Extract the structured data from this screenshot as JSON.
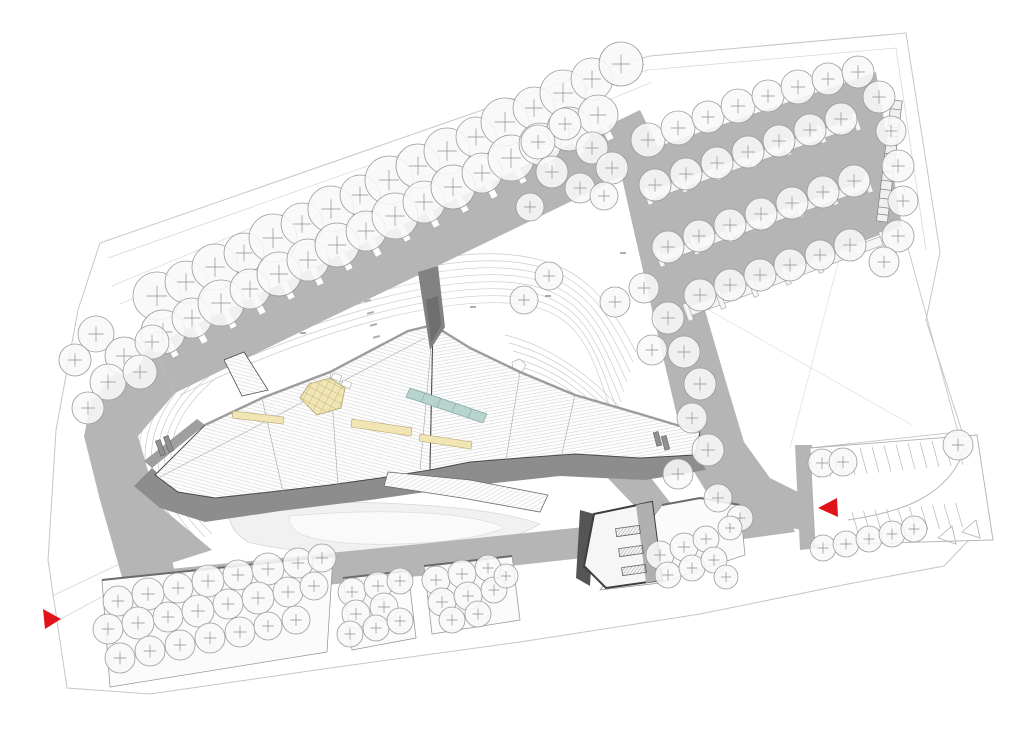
{
  "plan": {
    "kind": "architectural-site-plan",
    "canvas": {
      "width": 1024,
      "height": 737
    },
    "colors": {
      "background": "#ffffff",
      "paper_line": "#c6c6c6",
      "faint_line": "#dedede",
      "contour_line": "#cccccc",
      "road": "#b5b5b5",
      "road_edge": "#a3a3a3",
      "shadow": "#8d8d8d",
      "shadow_dark": "#6e6e6e",
      "building_outline": "#4a4a4a",
      "roof_hatch": "#c6c6c6",
      "roof_fill": "#fdfdfd",
      "tree_fill": "#f8f8f8",
      "tree_stroke": "#9b9b9b",
      "tree_cross": "#8f8f8f",
      "trunk_fill": "#ffffff",
      "trunk_stroke": "#ababab",
      "island_fill": "#f5f5f5",
      "island_stroke": "#a8a8a8",
      "stall_line": "#b8b8b8",
      "skylight_fill": "#f1e5b4",
      "skylight_line": "#b4a46e",
      "glass_fill": "#b9d3cf",
      "glass_line": "#7fa8a3",
      "plaza_fill": "#f1f1f1",
      "plaza_line": "#d8d8d8",
      "bed_fill": "#fbfbfb",
      "bed_edge": "#6a6a6a",
      "arrow_red": "#e0131b"
    },
    "markers": {
      "entrance_west": {
        "shape": "triangle",
        "direction": "right"
      },
      "entrance_east": {
        "shape": "triangle",
        "direction": "left"
      }
    },
    "trees": {
      "boulevard_upper": [
        [
          157,
          296,
          24
        ],
        [
          186,
          282,
          21
        ],
        [
          215,
          267,
          23
        ],
        [
          244,
          253,
          20
        ],
        [
          273,
          238,
          24
        ],
        [
          302,
          224,
          21
        ],
        [
          331,
          209,
          23
        ],
        [
          360,
          195,
          20
        ],
        [
          389,
          180,
          24
        ],
        [
          418,
          166,
          22
        ],
        [
          447,
          151,
          23
        ],
        [
          476,
          137,
          20
        ],
        [
          505,
          122,
          24
        ],
        [
          534,
          108,
          21
        ],
        [
          563,
          93,
          23
        ],
        [
          592,
          79,
          21
        ],
        [
          621,
          64,
          22
        ]
      ],
      "boulevard_lower": [
        [
          163,
          332,
          22
        ],
        [
          192,
          318,
          20
        ],
        [
          221,
          303,
          23
        ],
        [
          250,
          289,
          20
        ],
        [
          279,
          274,
          22
        ],
        [
          308,
          260,
          21
        ],
        [
          337,
          245,
          22
        ],
        [
          366,
          231,
          20
        ],
        [
          395,
          216,
          23
        ],
        [
          424,
          202,
          21
        ],
        [
          453,
          187,
          22
        ],
        [
          482,
          173,
          20
        ],
        [
          511,
          158,
          23
        ],
        [
          540,
          144,
          21
        ],
        [
          569,
          129,
          22
        ],
        [
          598,
          115,
          20
        ]
      ],
      "elbow_cluster": [
        [
          96,
          334,
          18
        ],
        [
          124,
          356,
          19
        ],
        [
          152,
          342,
          17
        ],
        [
          108,
          382,
          18
        ],
        [
          140,
          372,
          17
        ],
        [
          75,
          360,
          16
        ],
        [
          88,
          408,
          16
        ]
      ],
      "northeast_wedge": [
        [
          538,
          142,
          17
        ],
        [
          565,
          124,
          16
        ],
        [
          592,
          148,
          16
        ],
        [
          552,
          172,
          16
        ],
        [
          612,
          168,
          16
        ],
        [
          580,
          188,
          15
        ],
        [
          604,
          196,
          14
        ],
        [
          530,
          207,
          14
        ]
      ],
      "parking_top_edge": [
        [
          648,
          140,
          17
        ],
        [
          678,
          128,
          17
        ],
        [
          708,
          117,
          16
        ],
        [
          738,
          106,
          17
        ],
        [
          768,
          96,
          16
        ],
        [
          798,
          87,
          17
        ],
        [
          828,
          79,
          16
        ],
        [
          858,
          72,
          16
        ]
      ],
      "parking_right_edge": [
        [
          879,
          97,
          16
        ],
        [
          891,
          131,
          15
        ],
        [
          898,
          166,
          16
        ],
        [
          903,
          201,
          15
        ],
        [
          898,
          236,
          16
        ],
        [
          884,
          262,
          15
        ]
      ],
      "parking_row_a": [
        [
          655,
          185,
          16
        ],
        [
          686,
          174,
          16
        ],
        [
          717,
          163,
          16
        ],
        [
          748,
          152,
          16
        ],
        [
          779,
          141,
          16
        ],
        [
          810,
          130,
          16
        ],
        [
          841,
          119,
          16
        ]
      ],
      "parking_row_b": [
        [
          668,
          247,
          16
        ],
        [
          699,
          236,
          16
        ],
        [
          730,
          225,
          16
        ],
        [
          761,
          214,
          16
        ],
        [
          792,
          203,
          16
        ],
        [
          823,
          192,
          16
        ],
        [
          854,
          181,
          16
        ]
      ],
      "parking_south_edge": [
        [
          700,
          295,
          16
        ],
        [
          730,
          285,
          16
        ],
        [
          760,
          275,
          16
        ],
        [
          790,
          265,
          16
        ],
        [
          820,
          255,
          15
        ],
        [
          850,
          245,
          16
        ]
      ],
      "east_road_side": [
        [
          615,
          302,
          15
        ],
        [
          644,
          288,
          15
        ],
        [
          668,
          318,
          16
        ],
        [
          652,
          350,
          15
        ],
        [
          684,
          352,
          16
        ],
        [
          700,
          384,
          16
        ],
        [
          692,
          418,
          15
        ],
        [
          708,
          450,
          16
        ],
        [
          678,
          474,
          15
        ],
        [
          524,
          300,
          14
        ],
        [
          549,
          276,
          14
        ],
        [
          718,
          498,
          14
        ],
        [
          740,
          518,
          13
        ]
      ],
      "right_strip": [
        [
          822,
          463,
          14
        ],
        [
          843,
          462,
          14
        ],
        [
          958,
          445,
          15
        ],
        [
          823,
          548,
          13
        ],
        [
          846,
          544,
          13
        ],
        [
          869,
          539,
          13
        ],
        [
          892,
          534,
          13
        ],
        [
          914,
          529,
          13
        ]
      ],
      "bed1": [
        [
          118,
          601,
          15
        ],
        [
          148,
          594,
          16
        ],
        [
          178,
          588,
          15
        ],
        [
          208,
          581,
          16
        ],
        [
          238,
          575,
          15
        ],
        [
          268,
          569,
          16
        ],
        [
          298,
          563,
          15
        ],
        [
          322,
          558,
          14
        ],
        [
          108,
          629,
          15
        ],
        [
          138,
          623,
          16
        ],
        [
          168,
          617,
          15
        ],
        [
          198,
          611,
          16
        ],
        [
          228,
          604,
          15
        ],
        [
          258,
          598,
          16
        ],
        [
          288,
          592,
          15
        ],
        [
          314,
          586,
          14
        ],
        [
          120,
          658,
          15
        ],
        [
          150,
          651,
          15
        ],
        [
          180,
          645,
          15
        ],
        [
          210,
          638,
          15
        ],
        [
          240,
          632,
          15
        ],
        [
          268,
          626,
          14
        ],
        [
          296,
          620,
          14
        ]
      ],
      "bed2": [
        [
          352,
          592,
          14
        ],
        [
          378,
          586,
          14
        ],
        [
          400,
          581,
          13
        ],
        [
          356,
          614,
          14
        ],
        [
          384,
          607,
          14
        ],
        [
          350,
          634,
          13
        ],
        [
          376,
          628,
          13
        ],
        [
          400,
          621,
          13
        ]
      ],
      "bed3": [
        [
          436,
          580,
          14
        ],
        [
          462,
          574,
          14
        ],
        [
          488,
          568,
          13
        ],
        [
          442,
          602,
          14
        ],
        [
          468,
          596,
          14
        ],
        [
          494,
          590,
          13
        ],
        [
          452,
          620,
          13
        ],
        [
          478,
          614,
          13
        ],
        [
          506,
          576,
          12
        ]
      ],
      "bed4": [
        [
          660,
          555,
          14
        ],
        [
          684,
          547,
          14
        ],
        [
          706,
          539,
          13
        ],
        [
          668,
          575,
          13
        ],
        [
          692,
          568,
          13
        ],
        [
          714,
          560,
          13
        ],
        [
          730,
          528,
          12
        ],
        [
          726,
          577,
          12
        ]
      ]
    },
    "trunk_groups": [
      "boulevard_lower"
    ],
    "parking": {
      "islands": [
        [
          648,
          196,
          856,
          122
        ],
        [
          660,
          258,
          868,
          184
        ],
        [
          688,
          312,
          884,
          240
        ]
      ],
      "stub_count": 7,
      "stall_rows": [
        {
          "x": 812,
          "y": 452,
          "stepX": 12,
          "stepY": -1.1,
          "count": 13,
          "dx": 7,
          "dy": 26
        },
        {
          "x": 852,
          "y": 512,
          "stepX": 11.5,
          "stepY": -1.0,
          "count": 10,
          "dx": 7,
          "dy": 24
        }
      ]
    }
  }
}
